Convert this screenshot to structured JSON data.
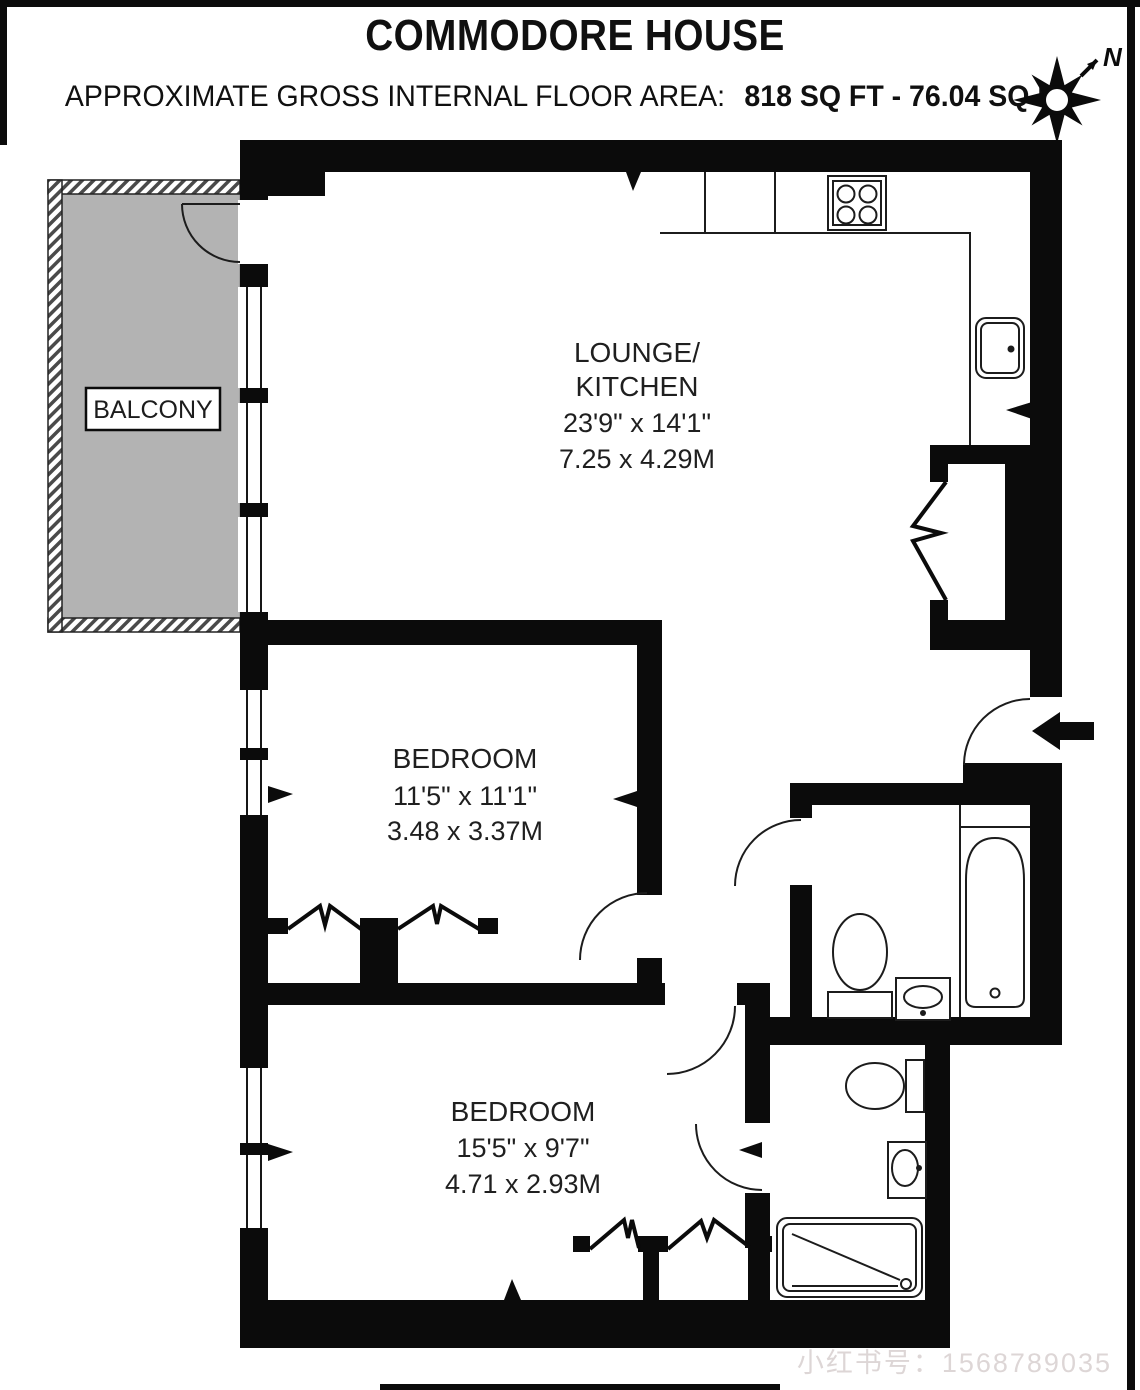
{
  "header": {
    "title": "COMMODORE HOUSE",
    "area_label": "APPROXIMATE GROSS INTERNAL FLOOR AREA:",
    "area_value": "818 SQ FT - 76.04 SQ M"
  },
  "compass": {
    "north": "N"
  },
  "rooms": {
    "lounge_kitchen": {
      "name_line1": "LOUNGE/",
      "name_line2": "KITCHEN",
      "imperial": "23'9\" x 14'1\"",
      "metric": "7.25 x 4.29M"
    },
    "bedroom1": {
      "name": "BEDROOM",
      "imperial": "11'5\" x 11'1\"",
      "metric": "3.48 x 3.37M"
    },
    "bedroom2": {
      "name": "BEDROOM",
      "imperial": "15'5\" x 9'7\"",
      "metric": "4.71 x 2.93M"
    },
    "balcony": {
      "name": "BALCONY"
    }
  },
  "watermark": "小红书号：1568789035",
  "colors": {
    "wall": "#0b0b0b",
    "line": "#1c1c1c",
    "balcony_fill": "#b3b3b3",
    "watermark_text": "#ddd6d6"
  }
}
